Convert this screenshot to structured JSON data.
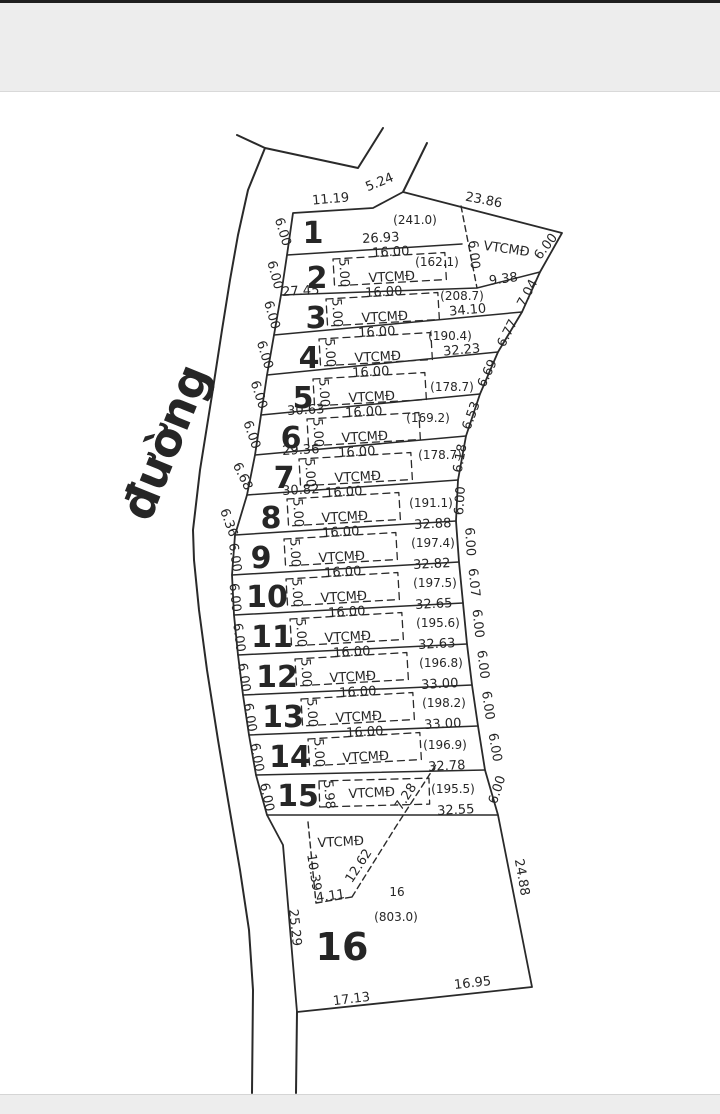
{
  "colors": {
    "ink": "#262626",
    "red": "#cf342e",
    "bar": "#ededed",
    "bar_edge": "#1f1f1f",
    "paper": "#ffffff"
  },
  "road": {
    "name_label": {
      "t": "đường",
      "x": 180,
      "y": 448,
      "r": -68,
      "s": 46,
      "b": true,
      "n": "road-name-label"
    }
  },
  "map": {
    "top_dims": [
      {
        "t": "11.19",
        "x": 331,
        "y": 203,
        "r": -5
      },
      {
        "t": "5.24",
        "x": 381,
        "y": 186,
        "r": -22
      },
      {
        "t": "23.86",
        "x": 483,
        "y": 204,
        "r": 11
      }
    ],
    "triangle": {
      "labels": [
        {
          "t": "VTCMĐ",
          "x": 506,
          "y": 253,
          "r": 8,
          "s": 13,
          "n": "vtcmd-triangle-label"
        },
        {
          "t": "6.00",
          "x": 470,
          "y": 255,
          "r": 85
        },
        {
          "t": "6.00",
          "x": 549,
          "y": 249,
          "r": -52
        }
      ]
    },
    "right_dims": [
      {
        "t": "9.38",
        "x": 504,
        "y": 283,
        "r": -8
      },
      {
        "t": "7.04",
        "x": 531,
        "y": 295,
        "r": -62
      },
      {
        "t": "6.77",
        "x": 511,
        "y": 335,
        "r": -63
      },
      {
        "t": "6.69",
        "x": 491,
        "y": 375,
        "r": -65
      },
      {
        "t": "6.53",
        "x": 475,
        "y": 417,
        "r": -70
      },
      {
        "t": "6.18",
        "x": 464,
        "y": 459,
        "r": -80
      },
      {
        "t": "6.00",
        "x": 464,
        "y": 501,
        "r": -86
      },
      {
        "t": "6.00",
        "x": 466,
        "y": 542,
        "r": 87
      },
      {
        "t": "6.07",
        "x": 470,
        "y": 583,
        "r": 84
      },
      {
        "t": "6.00",
        "x": 474,
        "y": 624,
        "r": 84
      },
      {
        "t": "6.00",
        "x": 479,
        "y": 665,
        "r": 83
      },
      {
        "t": "6.00",
        "x": 484,
        "y": 706,
        "r": 82
      },
      {
        "t": "6.00",
        "x": 491,
        "y": 748,
        "r": 80
      },
      {
        "t": "6.00",
        "x": 501,
        "y": 791,
        "r": -72
      },
      {
        "t": "24.88",
        "x": 518,
        "y": 878,
        "r": 80
      }
    ],
    "lots": [
      {
        "no": "1",
        "labels": [
          {
            "t": "1",
            "x": 313,
            "y": 243,
            "s": 30,
            "b": true,
            "c": "red",
            "n": "lot-number-1"
          },
          {
            "t": "(241.0)",
            "x": 415,
            "y": 224,
            "s": 12,
            "n": "lot-1-area"
          },
          {
            "t": "26.93",
            "x": 381,
            "y": 242,
            "r": -3
          },
          {
            "t": "6.00",
            "x": 279,
            "y": 233,
            "r": 73
          }
        ]
      },
      {
        "no": "2",
        "labels": [
          {
            "t": "2",
            "x": 317,
            "y": 288,
            "s": 30,
            "b": true,
            "c": "red",
            "n": "lot-number-2"
          },
          {
            "t": "16.00",
            "x": 391,
            "y": 256,
            "r": -3
          },
          {
            "t": "5.00",
            "x": 340,
            "y": 273,
            "r": 87
          },
          {
            "t": "VTCMĐ",
            "x": 392,
            "y": 281,
            "r": -3,
            "s": 13
          },
          {
            "t": "(162.1)",
            "x": 437,
            "y": 266,
            "s": 12,
            "n": "lot-2-area"
          },
          {
            "t": "6.00",
            "x": 271,
            "y": 276,
            "r": 75
          },
          {
            "t": "27.45",
            "x": 301,
            "y": 295,
            "r": -3
          }
        ]
      },
      {
        "no": "3",
        "labels": [
          {
            "t": "3",
            "x": 316,
            "y": 328,
            "s": 30,
            "b": true,
            "c": "red",
            "n": "lot-number-3"
          },
          {
            "t": "16.00",
            "x": 384,
            "y": 296,
            "r": -3
          },
          {
            "t": "5.00",
            "x": 333,
            "y": 313,
            "r": 87
          },
          {
            "t": "VTCMĐ",
            "x": 385,
            "y": 321,
            "r": -3,
            "s": 13
          },
          {
            "t": "(208.7)",
            "x": 462,
            "y": 300,
            "s": 12,
            "n": "lot-3-area"
          },
          {
            "t": "34.10",
            "x": 468,
            "y": 314,
            "r": -5
          },
          {
            "t": "6.00",
            "x": 268,
            "y": 316,
            "r": 74
          }
        ]
      },
      {
        "no": "4",
        "labels": [
          {
            "t": "4",
            "x": 309,
            "y": 368,
            "s": 30,
            "b": true,
            "c": "red",
            "n": "lot-number-4"
          },
          {
            "t": "16.00",
            "x": 377,
            "y": 336,
            "r": -3
          },
          {
            "t": "5.00",
            "x": 326,
            "y": 353,
            "r": 87
          },
          {
            "t": "VTCMĐ",
            "x": 378,
            "y": 361,
            "r": -3,
            "s": 13
          },
          {
            "t": "(190.4)",
            "x": 450,
            "y": 340,
            "s": 12,
            "n": "lot-4-area"
          },
          {
            "t": "32.23",
            "x": 462,
            "y": 354,
            "r": -5
          },
          {
            "t": "6.00",
            "x": 261,
            "y": 356,
            "r": 73
          }
        ]
      },
      {
        "no": "5",
        "labels": [
          {
            "t": "5",
            "x": 303,
            "y": 408,
            "s": 30,
            "b": true,
            "c": "red",
            "n": "lot-number-5"
          },
          {
            "t": "16.00",
            "x": 371,
            "y": 376,
            "r": -3
          },
          {
            "t": "5.00",
            "x": 320,
            "y": 393,
            "r": 87
          },
          {
            "t": "VTCMĐ",
            "x": 372,
            "y": 401,
            "r": -3,
            "s": 13
          },
          {
            "t": "(178.7)",
            "x": 452,
            "y": 391,
            "s": 12,
            "n": "lot-5-area"
          },
          {
            "t": "30.63",
            "x": 306,
            "y": 414,
            "r": -3
          },
          {
            "t": "6.00",
            "x": 255,
            "y": 396,
            "r": 72
          }
        ]
      },
      {
        "no": "6",
        "labels": [
          {
            "t": "6",
            "x": 291,
            "y": 448,
            "s": 30,
            "b": true,
            "c": "red",
            "n": "lot-number-6"
          },
          {
            "t": "16.00",
            "x": 364,
            "y": 416,
            "r": -3
          },
          {
            "t": "(169.2)",
            "x": 428,
            "y": 422,
            "s": 12,
            "n": "lot-6-area"
          },
          {
            "t": "5.00",
            "x": 314,
            "y": 433,
            "r": 87
          },
          {
            "t": "VTCMĐ",
            "x": 365,
            "y": 441,
            "r": -3,
            "s": 13
          },
          {
            "t": "29.36",
            "x": 301,
            "y": 454,
            "r": -3
          },
          {
            "t": "6.00",
            "x": 248,
            "y": 436,
            "r": 71
          }
        ]
      },
      {
        "no": "7",
        "labels": [
          {
            "t": "7",
            "x": 284,
            "y": 488,
            "s": 30,
            "b": true,
            "c": "red",
            "n": "lot-number-7"
          },
          {
            "t": "16.00",
            "x": 357,
            "y": 456,
            "r": -3
          },
          {
            "t": "(178.7)",
            "x": 440,
            "y": 459,
            "s": 12,
            "n": "lot-7-area"
          },
          {
            "t": "5.00",
            "x": 306,
            "y": 473,
            "r": 87
          },
          {
            "t": "VTCMĐ",
            "x": 358,
            "y": 481,
            "r": -3,
            "s": 13
          },
          {
            "t": "30.82",
            "x": 301,
            "y": 494,
            "r": -3
          },
          {
            "t": "6.68",
            "x": 239,
            "y": 478,
            "r": 64
          }
        ]
      },
      {
        "no": "8",
        "labels": [
          {
            "t": "8",
            "x": 271,
            "y": 528,
            "s": 30,
            "b": true,
            "c": "red",
            "n": "lot-number-8"
          },
          {
            "t": "16.00",
            "x": 344,
            "y": 496,
            "r": -3
          },
          {
            "t": "(191.1)",
            "x": 431,
            "y": 507,
            "s": 12,
            "n": "lot-8-area"
          },
          {
            "t": "5.00",
            "x": 294,
            "y": 513,
            "r": 87
          },
          {
            "t": "VTCMĐ",
            "x": 345,
            "y": 521,
            "r": -3,
            "s": 13
          },
          {
            "t": "32.88",
            "x": 433,
            "y": 528,
            "r": -3
          },
          {
            "t": "6.36",
            "x": 225,
            "y": 524,
            "r": 70
          }
        ]
      },
      {
        "no": "9",
        "labels": [
          {
            "t": "9",
            "x": 261,
            "y": 568,
            "s": 30,
            "b": true,
            "c": "red",
            "n": "lot-number-9"
          },
          {
            "t": "16.00",
            "x": 341,
            "y": 536,
            "r": -3
          },
          {
            "t": "(197.4)",
            "x": 433,
            "y": 547,
            "s": 12,
            "n": "lot-9-area"
          },
          {
            "t": "5.00",
            "x": 291,
            "y": 553,
            "r": 87
          },
          {
            "t": "VTCMĐ",
            "x": 342,
            "y": 561,
            "r": -3,
            "s": 13
          },
          {
            "t": "32.82",
            "x": 432,
            "y": 568,
            "r": -3
          },
          {
            "t": "6.00",
            "x": 231,
            "y": 558,
            "r": 82
          }
        ]
      },
      {
        "no": "10",
        "labels": [
          {
            "t": "10",
            "x": 267,
            "y": 607,
            "s": 30,
            "b": true,
            "c": "red",
            "n": "lot-number-10"
          },
          {
            "t": "16.00",
            "x": 343,
            "y": 576,
            "r": -3
          },
          {
            "t": "(197.5)",
            "x": 435,
            "y": 587,
            "s": 12,
            "n": "lot-10-area"
          },
          {
            "t": "5.00",
            "x": 293,
            "y": 593,
            "r": 87
          },
          {
            "t": "VTCMĐ",
            "x": 344,
            "y": 601,
            "r": -3,
            "s": 13
          },
          {
            "t": "32.65",
            "x": 434,
            "y": 608,
            "r": -3
          },
          {
            "t": "6.00",
            "x": 231,
            "y": 598,
            "r": 84
          }
        ]
      },
      {
        "no": "11",
        "labels": [
          {
            "t": "11",
            "x": 272,
            "y": 647,
            "s": 30,
            "b": true,
            "c": "red",
            "n": "lot-number-11"
          },
          {
            "t": "16.00",
            "x": 347,
            "y": 616,
            "r": -3
          },
          {
            "t": "(195.6)",
            "x": 438,
            "y": 627,
            "s": 12,
            "n": "lot-11-area"
          },
          {
            "t": "5.00",
            "x": 297,
            "y": 633,
            "r": 87
          },
          {
            "t": "VTCMĐ",
            "x": 348,
            "y": 641,
            "r": -3,
            "s": 13
          },
          {
            "t": "32.63",
            "x": 437,
            "y": 648,
            "r": -3
          },
          {
            "t": "6.00",
            "x": 235,
            "y": 638,
            "r": 83
          }
        ]
      },
      {
        "no": "12",
        "labels": [
          {
            "t": "12",
            "x": 277,
            "y": 687,
            "s": 30,
            "b": true,
            "c": "red",
            "n": "lot-number-12"
          },
          {
            "t": "16.00",
            "x": 352,
            "y": 656,
            "r": -3
          },
          {
            "t": "(196.8)",
            "x": 441,
            "y": 667,
            "s": 12,
            "n": "lot-12-area"
          },
          {
            "t": "5.00",
            "x": 302,
            "y": 673,
            "r": 87
          },
          {
            "t": "VTCMĐ",
            "x": 353,
            "y": 681,
            "r": -3,
            "s": 13
          },
          {
            "t": "33.00",
            "x": 440,
            "y": 688,
            "r": -3
          },
          {
            "t": "6.00",
            "x": 240,
            "y": 678,
            "r": 82
          }
        ]
      },
      {
        "no": "13",
        "labels": [
          {
            "t": "13",
            "x": 283,
            "y": 727,
            "s": 30,
            "b": true,
            "c": "red",
            "n": "lot-number-13"
          },
          {
            "t": "16.00",
            "x": 358,
            "y": 696,
            "r": -3
          },
          {
            "t": "(198.2)",
            "x": 444,
            "y": 707,
            "s": 12,
            "n": "lot-13-area"
          },
          {
            "t": "5.00",
            "x": 308,
            "y": 713,
            "r": 87
          },
          {
            "t": "VTCMĐ",
            "x": 359,
            "y": 721,
            "r": -3,
            "s": 13
          },
          {
            "t": "33.00",
            "x": 443,
            "y": 728,
            "r": -3
          },
          {
            "t": "6.00",
            "x": 246,
            "y": 718,
            "r": 81
          }
        ]
      },
      {
        "no": "14",
        "labels": [
          {
            "t": "14",
            "x": 290,
            "y": 767,
            "s": 30,
            "b": true,
            "c": "red",
            "n": "lot-number-14"
          },
          {
            "t": "16.00",
            "x": 365,
            "y": 736,
            "r": -3
          },
          {
            "t": "(196.9)",
            "x": 445,
            "y": 749,
            "s": 12,
            "n": "lot-14-area"
          },
          {
            "t": "5.00",
            "x": 315,
            "y": 753,
            "r": 87
          },
          {
            "t": "VTCMĐ",
            "x": 366,
            "y": 761,
            "r": -3,
            "s": 13
          },
          {
            "t": "32.78",
            "x": 447,
            "y": 770,
            "r": -3
          },
          {
            "t": "6.00",
            "x": 253,
            "y": 758,
            "r": 80
          }
        ]
      },
      {
        "no": "15",
        "labels": [
          {
            "t": "15",
            "x": 298,
            "y": 806,
            "s": 30,
            "b": true,
            "c": "red",
            "n": "lot-number-15"
          },
          {
            "t": "VTCMĐ",
            "x": 372,
            "y": 797,
            "r": -3,
            "s": 13
          },
          {
            "t": "5.98",
            "x": 325,
            "y": 795,
            "r": 85
          },
          {
            "t": "(195.5)",
            "x": 453,
            "y": 793,
            "s": 12,
            "n": "lot-15-area"
          },
          {
            "t": "32.55",
            "x": 456,
            "y": 814,
            "r": -3
          },
          {
            "t": "7.28",
            "x": 409,
            "y": 799,
            "r": -57
          },
          {
            "t": "6.00",
            "x": 263,
            "y": 798,
            "r": 78
          }
        ]
      },
      {
        "no": "16",
        "labels": [
          {
            "t": "16",
            "x": 342,
            "y": 960,
            "s": 38,
            "b": true,
            "c": "red",
            "n": "lot-number-16"
          },
          {
            "t": "VTCMĐ",
            "x": 341,
            "y": 846,
            "r": -3,
            "s": 13,
            "n": "vtcmd-wedge-label"
          },
          {
            "t": "10.39",
            "x": 310,
            "y": 873,
            "r": 81
          },
          {
            "t": "12.62",
            "x": 362,
            "y": 868,
            "r": -57
          },
          {
            "t": "4.11",
            "x": 331,
            "y": 900,
            "r": -8
          },
          {
            "t": "25.29",
            "x": 291,
            "y": 928,
            "r": 84
          },
          {
            "t": "16",
            "x": 397,
            "y": 896,
            "s": 12,
            "n": "lot-16-small-number"
          },
          {
            "t": "(803.0)",
            "x": 396,
            "y": 921,
            "s": 12,
            "n": "lot-16-area"
          },
          {
            "t": "17.13",
            "x": 352,
            "y": 1003,
            "r": -7
          },
          {
            "t": "16.95",
            "x": 473,
            "y": 987,
            "r": -6
          }
        ]
      }
    ]
  }
}
